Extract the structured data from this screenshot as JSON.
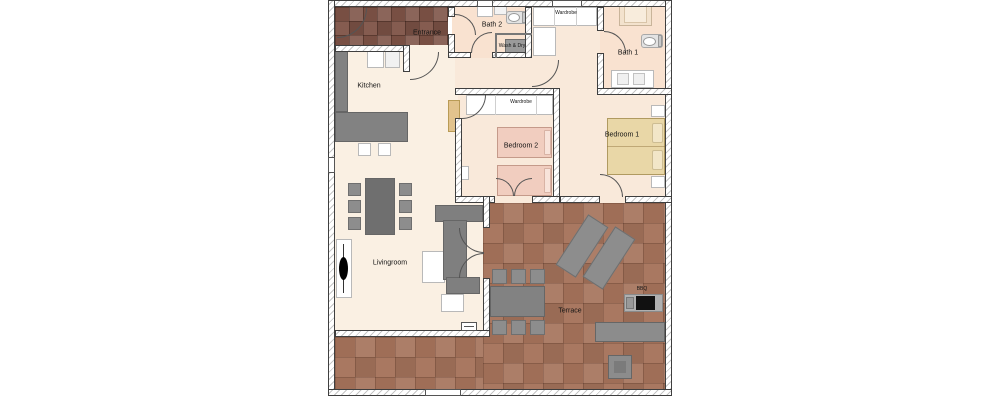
{
  "rooms": {
    "entrance": {
      "label": "Entrance"
    },
    "kitchen": {
      "label": "Kitchen"
    },
    "bath2": {
      "label": "Bath 2"
    },
    "wash_dry": {
      "label": "Wash & Dry"
    },
    "hall_wardrobe": {
      "label": "Wardrobe"
    },
    "bath1": {
      "label": "Bath 1"
    },
    "bedroom2": {
      "label": "Bedroom 2"
    },
    "bedroom2_wardrobe": {
      "label": "Wardrobe"
    },
    "bedroom1": {
      "label": "Bedroom 1"
    },
    "livingroom": {
      "label": "Livingroom"
    },
    "terrace": {
      "label": "Terrace"
    },
    "bbq": {
      "label": "BBQ"
    }
  },
  "colors": {
    "wall_outline": "#3f3f3f",
    "floor_living": "#faf0e3",
    "floor_bedroom": "#f9e9da",
    "floor_bath": "#f9e2d0",
    "entrance_tile": "#7e5347",
    "terrace_tile": "#a5735b",
    "furniture_gray": "#828282",
    "double_bed": "#e9d7a7",
    "single_bed": "#f1cdbf"
  }
}
